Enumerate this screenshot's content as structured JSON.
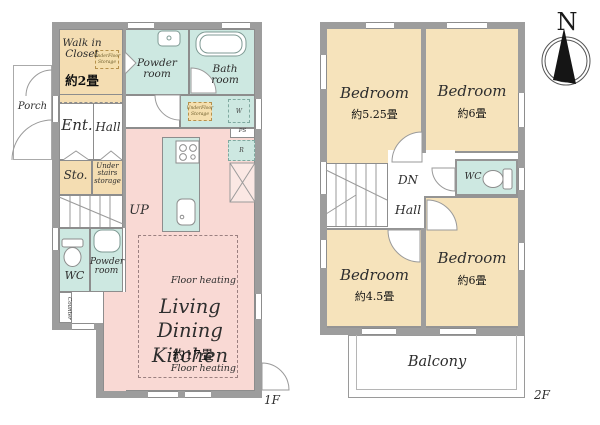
{
  "palette": {
    "wall": "#9d9d9d",
    "teal": "#cde8e1",
    "storage_tan": "#f4ddb2",
    "bedroom_tan": "#f6e3bb",
    "ldk_pink": "#f9d9d4",
    "white": "#ffffff",
    "line": "#8d8d8d",
    "text": "#2e2e2e",
    "dash_heat": "#9b8080"
  },
  "floor1": {
    "floor_label": "1F",
    "porch": "Porch",
    "walk_in_closet_name": "Walk in Closet",
    "walk_in_closet_size": "約2畳",
    "underfloor_storage": "UnderFloor Storage",
    "powder_room": "Powder room",
    "bath_room": "Bath room",
    "ent": "Ent.",
    "hall": "Hall",
    "sto": "Sto.",
    "under_stairs_storage": "Under stairs storage",
    "up": "UP",
    "wc": "WC",
    "counter": "Counter",
    "washer": "W",
    "pipe_space": "PS",
    "refrigerator": "R",
    "ldk_name": "Living Dining Kitchen",
    "ldk_size": "約17畳",
    "floor_heating": "Floor heating"
  },
  "floor2": {
    "floor_label": "2F",
    "compass_north": "N",
    "bedrooms": [
      {
        "name": "Bedroom",
        "size": "約5.25畳"
      },
      {
        "name": "Bedroom",
        "size": "約6畳"
      },
      {
        "name": "Bedroom",
        "size": "約4.5畳"
      },
      {
        "name": "Bedroom",
        "size": "約6畳"
      }
    ],
    "dn": "DN",
    "hall": "Hall",
    "wc": "WC",
    "balcony": "Balcony"
  }
}
